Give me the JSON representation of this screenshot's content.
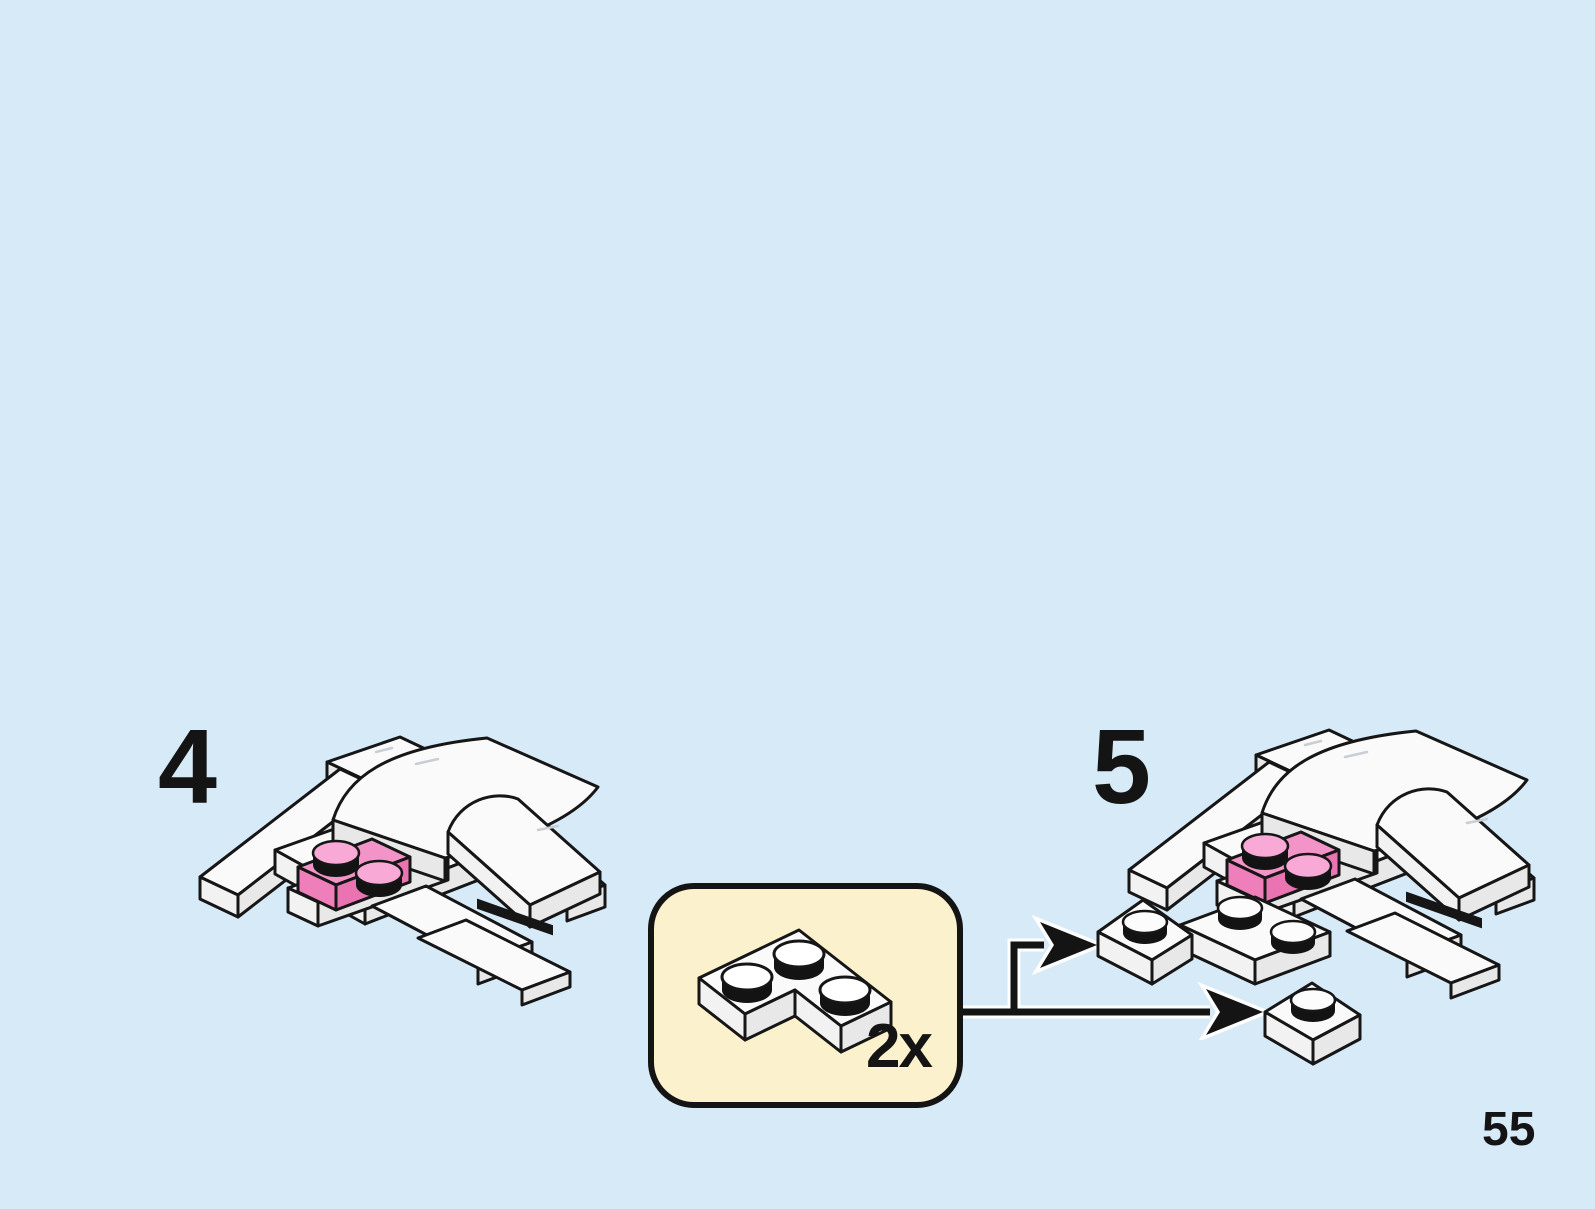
{
  "page": {
    "number": "55",
    "background_color": "#d7eaf8"
  },
  "steps": [
    {
      "number": "4",
      "model": "white-curved-body-with-pink-1x2-plate-and-wing-plates"
    },
    {
      "number": "5",
      "model": "white-curved-body-with-pink-1x2-plate-plus-two-added-corner-plates"
    }
  ],
  "parts_callout": {
    "quantity": "2x",
    "part_icon": "white-2x2-corner-plate-icon",
    "fill_color": "#fbf2cd",
    "border_color": "#141414"
  },
  "arrows": {
    "icon": "placement-arrows",
    "count": 2,
    "color": "#141414"
  },
  "colors": {
    "outline": "#161616",
    "brick_white_top": "#fafafa",
    "brick_white_side": "#e8e8e8",
    "plate_pink_top": "#f294c8",
    "plate_pink_side": "#ef7fbb",
    "stud_pink": "#f9a9d6",
    "stud_shadow": "#131313"
  }
}
